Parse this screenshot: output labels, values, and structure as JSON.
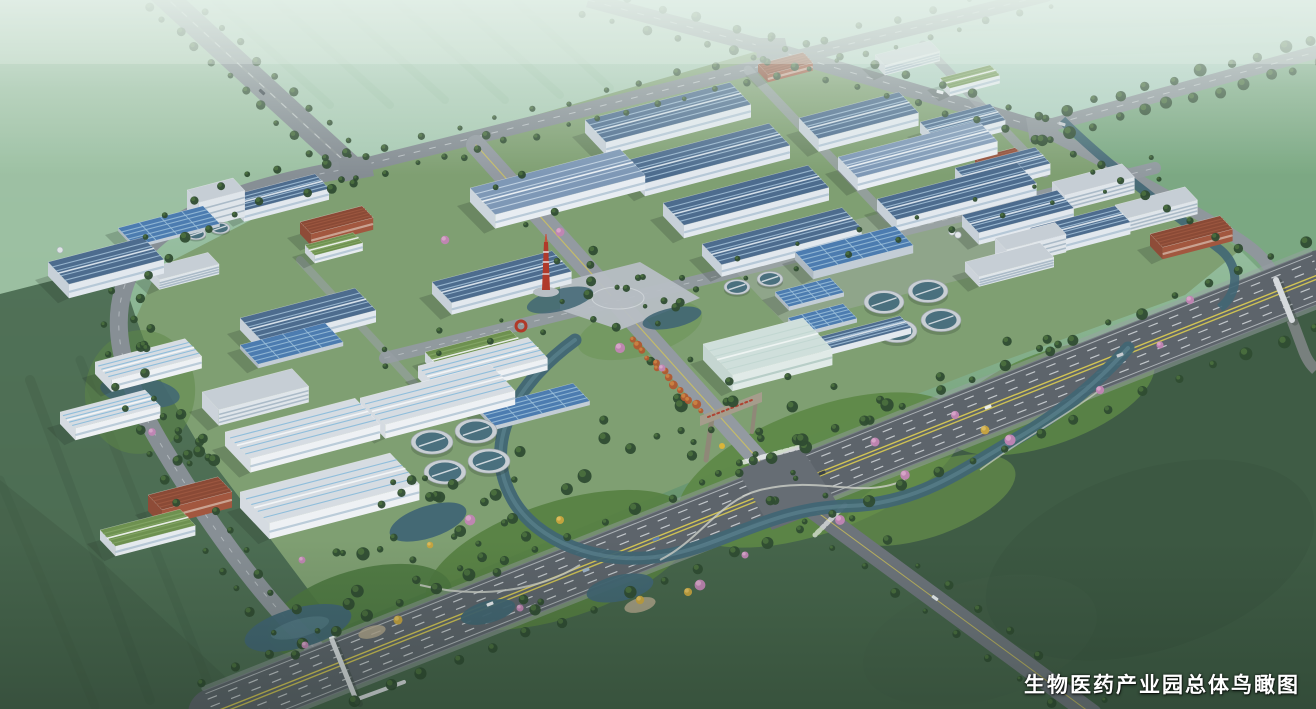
{
  "caption": {
    "text": "生物医药产业园总体鸟瞰图"
  },
  "scene": {
    "type": "3d-aerial-masterplan-rendering",
    "subject": "biomedical industrial park overall bird's-eye view",
    "features": [
      "factory-buildings-blue-roofs",
      "white-warehouse-buildings",
      "wastewater-treatment-round-tanks",
      "central-plaza-red-monument",
      "main-entrance-gate",
      "landscaped-river-park",
      "arterial-road-intersections",
      "pedestrian-bridges",
      "farmland-fields",
      "tree-lined-roads"
    ]
  },
  "palette": {
    "fieldTopLeft": "#9cc0a2",
    "fieldTopMid": "#a9cab3",
    "fieldTopRight": "#aecfc0",
    "fieldEast": "#78a57e",
    "fieldSoutheast": "#3f5c45",
    "fieldSouthwest": "#4b6a51",
    "parkGround": "#7f9f72",
    "parkLawn": "#5d8746",
    "roadAsphalt": "#858d93",
    "avenueAsphalt": "#5d646b",
    "roadLight": "#939aa1",
    "laneYellow": "#d9ca52",
    "laneWhite": "#eef2f4",
    "treeDark": "#2f4c31",
    "treeMid": "#4f7440",
    "treePink": "#c285b4",
    "treeYellow": "#c8a43e",
    "treeAutumn": "#b05a30",
    "water": "#416674",
    "waterLight": "#6e97a3",
    "roofBlue": "#4d6c8e",
    "roofBlueLight": "#7e98b6",
    "roofWhite": "#d6dce2",
    "skylightBlue": "#7fb7da",
    "roofStripe": "#a9c6dd",
    "wallWhite": "#eef1f4",
    "wallShade": "#ccd5dd",
    "roofGreen": "#6e9150",
    "brickRed": "#a2573f",
    "tealRoof": "#cfdfdb",
    "panelBlue": "#4c7cb0",
    "tankRing": "#c9cfd4",
    "tankWater": "#4a707e",
    "plazaPaving": "#b7bec4",
    "monumentRed": "#b03a2a",
    "gateStone": "#a59d8c",
    "hazeWhite": "#e8f2ec",
    "captionColor": "#ffffff"
  }
}
